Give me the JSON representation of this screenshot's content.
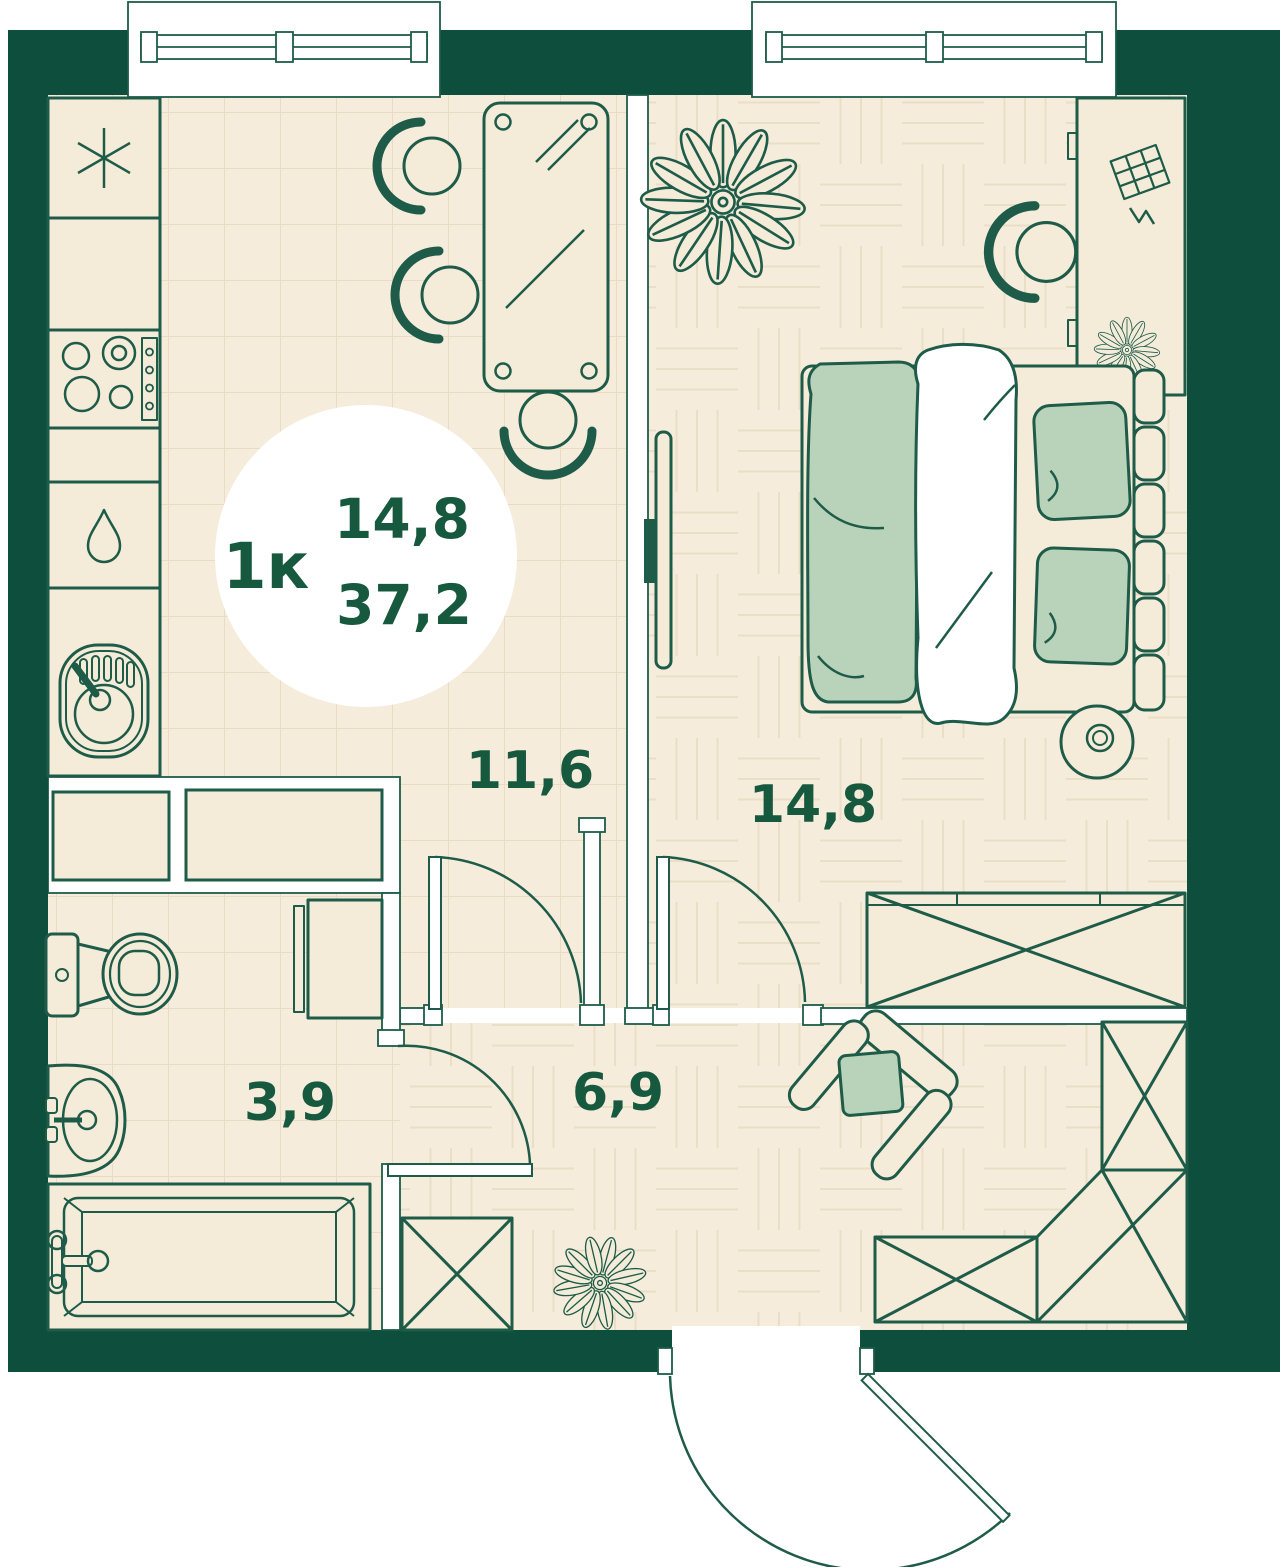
{
  "plan": {
    "badge": {
      "unit_type": "1к",
      "living_area": "14,8",
      "total_area": "37,2"
    },
    "rooms": [
      {
        "name": "kitchen-living-room",
        "area": "11,6"
      },
      {
        "name": "bedroom",
        "area": "14,8"
      },
      {
        "name": "bathroom",
        "area": "3,9"
      },
      {
        "name": "hallway",
        "area": "6,9"
      }
    ],
    "colors": {
      "wall": "#0d4e3d",
      "line": "#1e5c49",
      "floor": "#f5ecdb",
      "tile_line": "#e9dcc3",
      "furniture_fill": "#f4ebd9",
      "accent_green": "#b9d3ba",
      "text": "#17593f",
      "white": "#ffffff"
    }
  }
}
